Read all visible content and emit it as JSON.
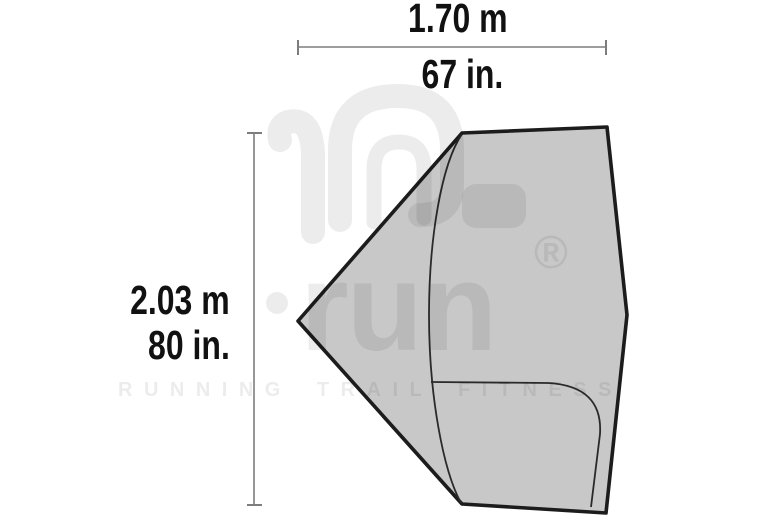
{
  "diagram": {
    "title": "tent footprint dimension diagram",
    "dimensions": {
      "width": {
        "metric": "1.70 m",
        "imperial": "67 in."
      },
      "height": {
        "metric": "2.03 m",
        "imperial": "80 in."
      }
    }
  },
  "watermark": {
    "brand": "i-run",
    "run_text": "run",
    "registered": "®",
    "tagline": "RUNNING TRAIL FITNESS"
  },
  "colors": {
    "shape_fill": "#c8c8c8",
    "shape_outline": "#1c1c1c",
    "interior_line": "#2a2a2a",
    "dimension_line": "#7d7d7d",
    "label_text": "#111111",
    "watermark": "rgba(0,0,0,0.075)"
  }
}
